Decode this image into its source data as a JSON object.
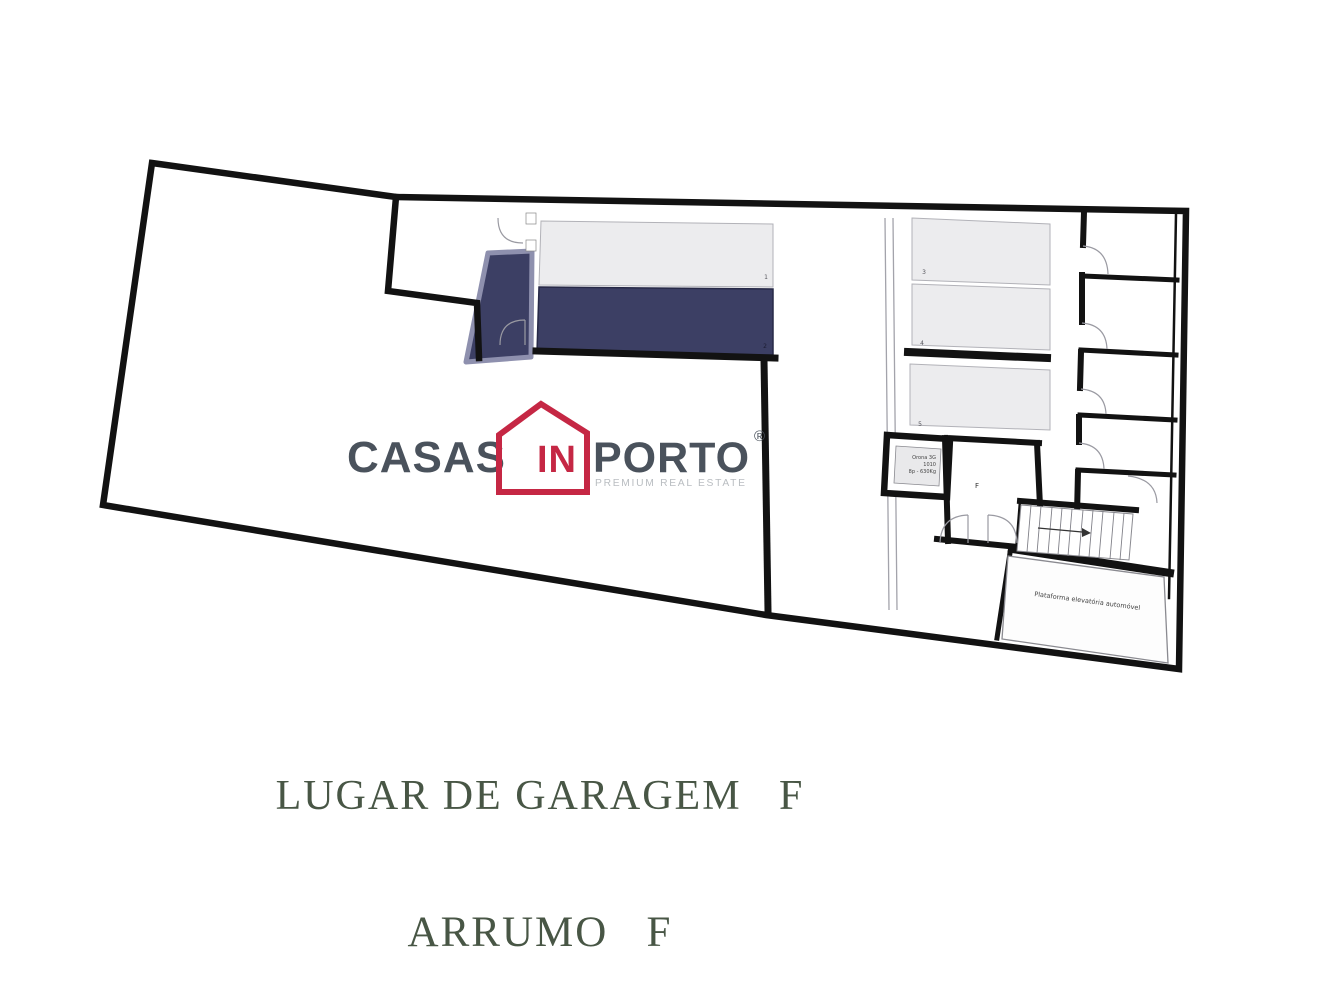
{
  "captions": {
    "line1": "LUGAR DE GARAGEM   F",
    "line2": "ARRUMO   F"
  },
  "logo": {
    "word1": "CASAS",
    "word2": "IN",
    "word3": "PORTO",
    "registered": "®",
    "tagline": "PREMIUM REAL ESTATE"
  },
  "floorplan": {
    "space_numbers": [
      "1",
      "2",
      "3",
      "4",
      "5"
    ],
    "storage_room_label": "F",
    "elevator": {
      "line1": "Orona 3G",
      "line2": "1010",
      "line3": "8p - 630Kg"
    },
    "platform_label": "Plataforma elevatória automóvel"
  },
  "colors": {
    "wall_black": "#121212",
    "highlight_navy": "#3c3f64",
    "highlight_glow": "#8e90ae",
    "space_gray": "#ececee",
    "logo_gray": "#4a525c",
    "logo_red": "#c52744",
    "tagline_gray": "#b9bdc1",
    "caption_green": "#485645"
  }
}
